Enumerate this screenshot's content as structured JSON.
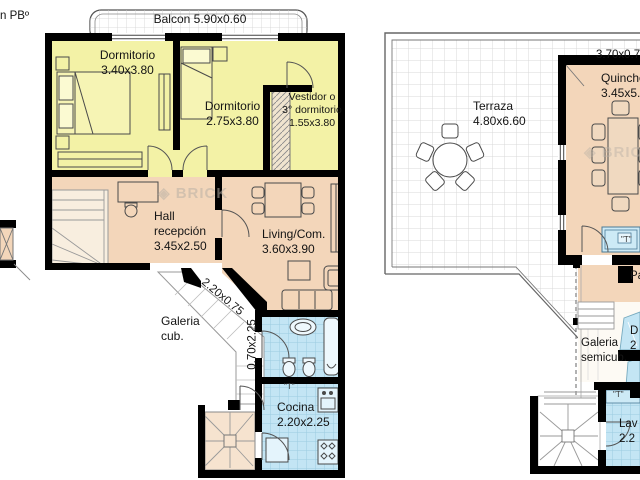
{
  "meta": {
    "corner_note": "n PBº"
  },
  "watermark": {
    "glyph": "◈",
    "text": "BRICK"
  },
  "colors": {
    "room_yellow": "#f3f2a6",
    "room_tan": "#f3d6ba",
    "wet_room_blue": "#c3e5f4",
    "tile_line_blue": "#9bcbe0",
    "wall_black": "#000000",
    "terrace_grid": "#d9d9d9"
  },
  "floor1": {
    "balcony_label": "Balcon 5.90x0.60",
    "dorm1": {
      "l1": "Dormitorio",
      "l2": "3.40x3.80"
    },
    "dorm2": {
      "l1": "Dormitorio",
      "l2": "2.75x3.80"
    },
    "vestidor": {
      "l1": "Vestidor o",
      "l2": "3° dormitorio",
      "l3": "1.55x3.80"
    },
    "hall": {
      "l1": "Hall",
      "l2": "recepción",
      "l3": "3.45x2.50"
    },
    "living": {
      "l1": "Living/Com.",
      "l2": "3.60x3.90"
    },
    "galeria": {
      "l1": "Galeria",
      "l2": "cub."
    },
    "cocina": {
      "l1": "Cocina",
      "l2": "2.20x2.25"
    },
    "passage_diag": "2.20x0.75",
    "passage_vert": "0.70x2.25",
    "tap": "\"T\""
  },
  "floor2": {
    "front_dim": "3.70x0.7",
    "terraza": {
      "l1": "Terraza",
      "l2": "4.80x6.60"
    },
    "quincho": {
      "l1": "Quincho",
      "l2": "3.45x5.8"
    },
    "galeria_semi": {
      "l1": "Galeria",
      "l2": "semicub."
    },
    "pa_fragment": "Pa",
    "cut_room": {
      "l1": "D",
      "l2": "2"
    },
    "lavadero": {
      "l1": "Lav",
      "l2": "2.2"
    },
    "tap": "\"T\""
  }
}
